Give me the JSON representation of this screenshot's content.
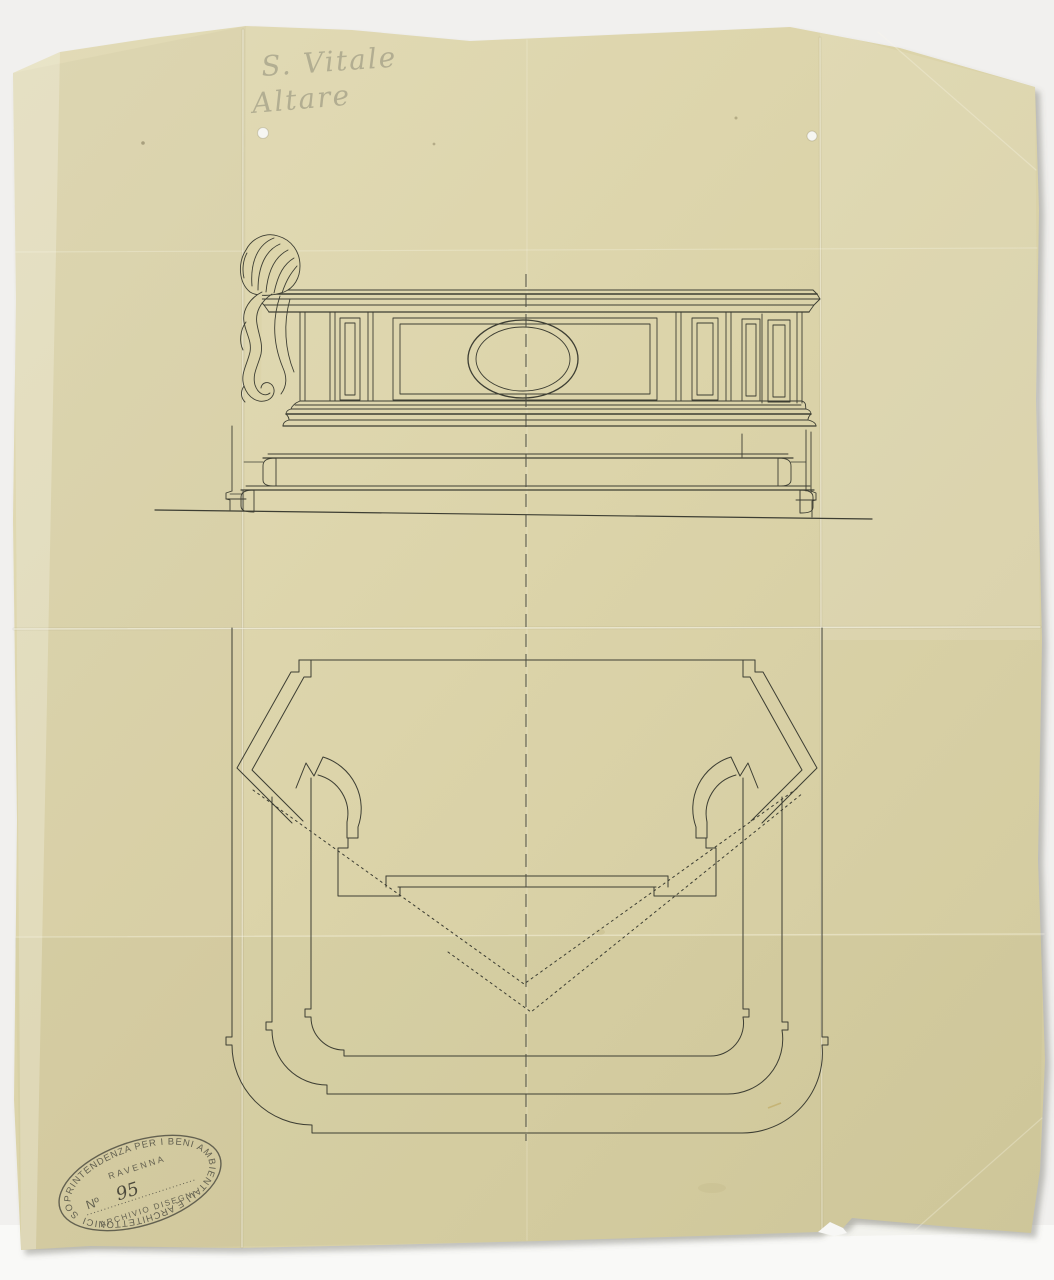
{
  "scan": {
    "background_color": "#f1f0ee",
    "paper_color": "#dcd4aa",
    "ink_color": "#3d3e33",
    "pencil_color": "#97947e",
    "stamp_color": "#504f43",
    "annotations": {
      "line1": "S. Vitale",
      "line2": "Altare"
    },
    "stamp": {
      "ring_text": "SOPRINTENDENZA PER I BENI AMBIENTALI E ARCHITETTONICI",
      "city": "RAVENNA",
      "number_label": "Nº",
      "number_value": "95",
      "archive_label": "ARCHIVIO DISEGNI"
    }
  }
}
